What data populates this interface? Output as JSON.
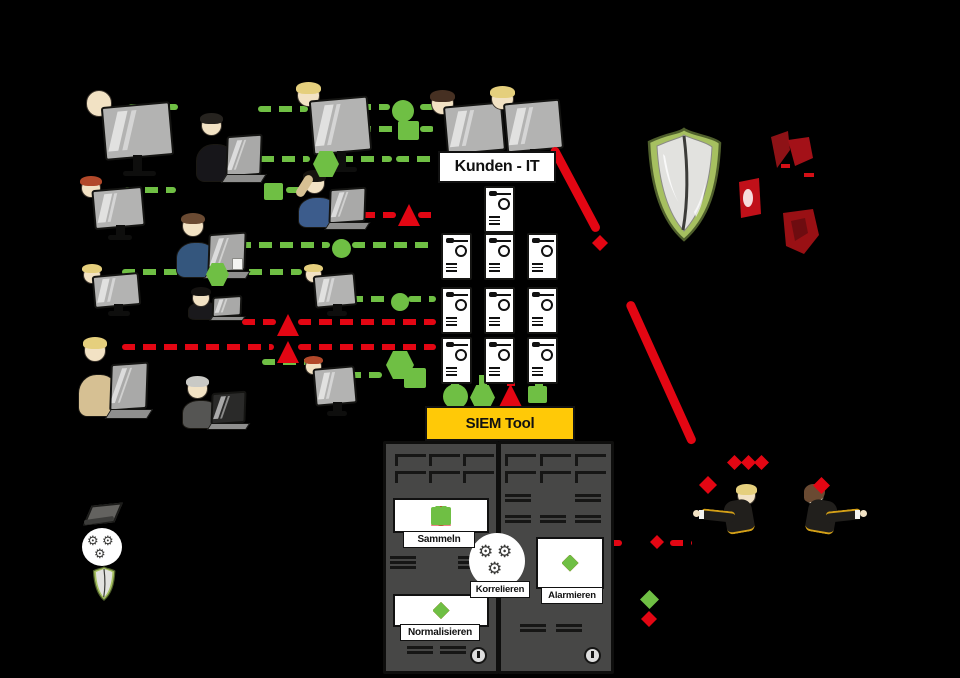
{
  "stage": {
    "width": 960,
    "height": 678,
    "background": "#000000"
  },
  "labels": {
    "kunden_it": "Kunden - IT",
    "siem_tool": "SIEM Tool",
    "sammeln": "Sammeln",
    "korrelieren": "Korrelieren",
    "normalisieren": "Normalisieren",
    "alarmieren": "Alarmieren"
  },
  "colors": {
    "event_green": "#6fbf44",
    "alert_red": "#e30613",
    "siem_yellow": "#ffc907",
    "rack_gray": "#474746",
    "shield_green": "#a6c060",
    "devil_red": "#9d1317",
    "monitor_gray": "#b3b3b2",
    "skin": "#f2e2c4"
  },
  "icons": [
    "server-icon",
    "shield-icon",
    "gear-icon",
    "power-icon",
    "monitor-icon",
    "laptop-icon",
    "alert-triangle-icon",
    "event-circle-icon",
    "event-square-icon",
    "event-hexagon-icon",
    "alert-diamond-icon",
    "ok-diamond-icon"
  ],
  "sequences": {
    "sammeln_events": [
      "circle-g",
      "hexagon-g",
      "triangle-r",
      "square-g"
    ],
    "siem_input_events": [
      "circle-g",
      "hexagon-g",
      "triangle-r",
      "square-g"
    ],
    "normalisieren_events": [
      "diamond-g",
      "diamond-g",
      "diamond-r",
      "diamond-g"
    ],
    "alarmieren_events": [
      "diamond-g",
      "diamond-g",
      "diamond-r",
      "diamond-g"
    ]
  },
  "glyphs": [
    {
      "t": "circle",
      "c": "g",
      "x": 392,
      "y": 100,
      "s": 22
    },
    {
      "t": "square",
      "c": "g",
      "x": 398,
      "y": 121,
      "s": 21
    },
    {
      "t": "hexagon",
      "c": "g",
      "x": 313,
      "y": 151,
      "s": 26
    },
    {
      "t": "square",
      "c": "g",
      "x": 264,
      "y": 183,
      "s": 19
    },
    {
      "t": "triangle",
      "c": "r",
      "x": 398,
      "y": 204,
      "s": 22
    },
    {
      "t": "circle",
      "c": "g",
      "x": 332,
      "y": 239,
      "s": 19
    },
    {
      "t": "hexagon",
      "c": "g",
      "x": 206,
      "y": 263,
      "s": 23
    },
    {
      "t": "circle",
      "c": "g",
      "x": 391,
      "y": 293,
      "s": 18
    },
    {
      "t": "triangle",
      "c": "r",
      "x": 277,
      "y": 314,
      "s": 22
    },
    {
      "t": "triangle",
      "c": "r",
      "x": 277,
      "y": 341,
      "s": 22
    },
    {
      "t": "hexagon",
      "c": "g",
      "x": 386,
      "y": 351,
      "s": 28
    },
    {
      "t": "square",
      "c": "g",
      "x": 404,
      "y": 368,
      "s": 22
    },
    {
      "t": "circle",
      "c": "g",
      "x": 443,
      "y": 384,
      "s": 25
    },
    {
      "t": "hexagon",
      "c": "g",
      "x": 470,
      "y": 385,
      "s": 25
    },
    {
      "t": "triangle",
      "c": "r",
      "x": 498,
      "y": 384,
      "s": 25
    },
    {
      "t": "square",
      "c": "g",
      "x": 528,
      "y": 386,
      "s": 19
    },
    {
      "t": "diamond",
      "c": "r",
      "x": 592,
      "y": 235,
      "s": 16
    },
    {
      "t": "diamond",
      "c": "r",
      "x": 727,
      "y": 455,
      "s": 15
    },
    {
      "t": "diamond",
      "c": "r",
      "x": 741,
      "y": 455,
      "s": 15
    },
    {
      "t": "diamond",
      "c": "r",
      "x": 754,
      "y": 455,
      "s": 15
    },
    {
      "t": "diamond",
      "c": "r",
      "x": 699,
      "y": 476,
      "s": 18
    },
    {
      "t": "diamond",
      "c": "r",
      "x": 813,
      "y": 477,
      "s": 17
    },
    {
      "t": "diamond",
      "c": "r",
      "x": 650,
      "y": 535,
      "s": 14
    },
    {
      "t": "diamond",
      "c": "g",
      "x": 640,
      "y": 590,
      "s": 19
    },
    {
      "t": "diamond",
      "c": "r",
      "x": 641,
      "y": 611,
      "s": 16
    }
  ],
  "people": [
    {
      "kind": "monitor",
      "x": 84,
      "y": 90,
      "w": 88,
      "h": 86,
      "hair": "none",
      "shirt": "#6d6d6b"
    },
    {
      "kind": "laptop",
      "x": 196,
      "y": 112,
      "w": 68,
      "h": 74,
      "hair": "#26231f",
      "shirt": "#17161a"
    },
    {
      "kind": "monitor",
      "x": 296,
      "y": 84,
      "w": 74,
      "h": 88,
      "hair": "#e5cf7d",
      "shirt": "#e8a27c"
    },
    {
      "kind": "monitor",
      "x": 430,
      "y": 92,
      "w": 74,
      "h": 78,
      "hair": "#463022",
      "shirt": "#2a2a2e"
    },
    {
      "kind": "monitor",
      "x": 490,
      "y": 88,
      "w": 72,
      "h": 80,
      "hair": "#e5cf7d",
      "shirt": "#888"
    },
    {
      "kind": "monitor",
      "x": 80,
      "y": 178,
      "w": 64,
      "h": 62,
      "hair": "#b2492a",
      "shirt": "#555"
    },
    {
      "kind": "laptop",
      "x": 298,
      "y": 170,
      "w": 70,
      "h": 62,
      "hair": "#17140f",
      "shirt": "#3c5c8c",
      "cat": true
    },
    {
      "kind": "laptop",
      "x": 176,
      "y": 212,
      "w": 72,
      "h": 70,
      "hair": "#6a4a32",
      "shirt": "#34567d",
      "cup": true
    },
    {
      "kind": "monitor",
      "x": 82,
      "y": 266,
      "w": 58,
      "h": 50,
      "hair": "#e5cf7d",
      "shirt": "#777"
    },
    {
      "kind": "monitor",
      "x": 304,
      "y": 266,
      "w": 52,
      "h": 50,
      "hair": "#e5cf7d",
      "shirt": "#777"
    },
    {
      "kind": "laptop",
      "x": 188,
      "y": 288,
      "w": 56,
      "h": 34,
      "hair": "#141210",
      "shirt": "#1a191c"
    },
    {
      "kind": "laptop",
      "x": 78,
      "y": 336,
      "w": 72,
      "h": 86,
      "hair": "#e5cf7d",
      "shirt": "#d6c093"
    },
    {
      "kind": "laptop",
      "x": 182,
      "y": 376,
      "w": 66,
      "h": 56,
      "hair": "#c9c9c5",
      "shirt": "#555553",
      "dark": true
    },
    {
      "kind": "monitor",
      "x": 304,
      "y": 358,
      "w": 52,
      "h": 58,
      "hair": "#b2492a",
      "shirt": "#777"
    },
    {
      "kind": "analyst",
      "x": 712,
      "y": 486,
      "w": 60,
      "h": 54,
      "hair": "#e5cf7d",
      "flip": false
    },
    {
      "kind": "analyst",
      "x": 788,
      "y": 486,
      "w": 62,
      "h": 54,
      "hair": "#6a4a32",
      "flip": true
    }
  ]
}
